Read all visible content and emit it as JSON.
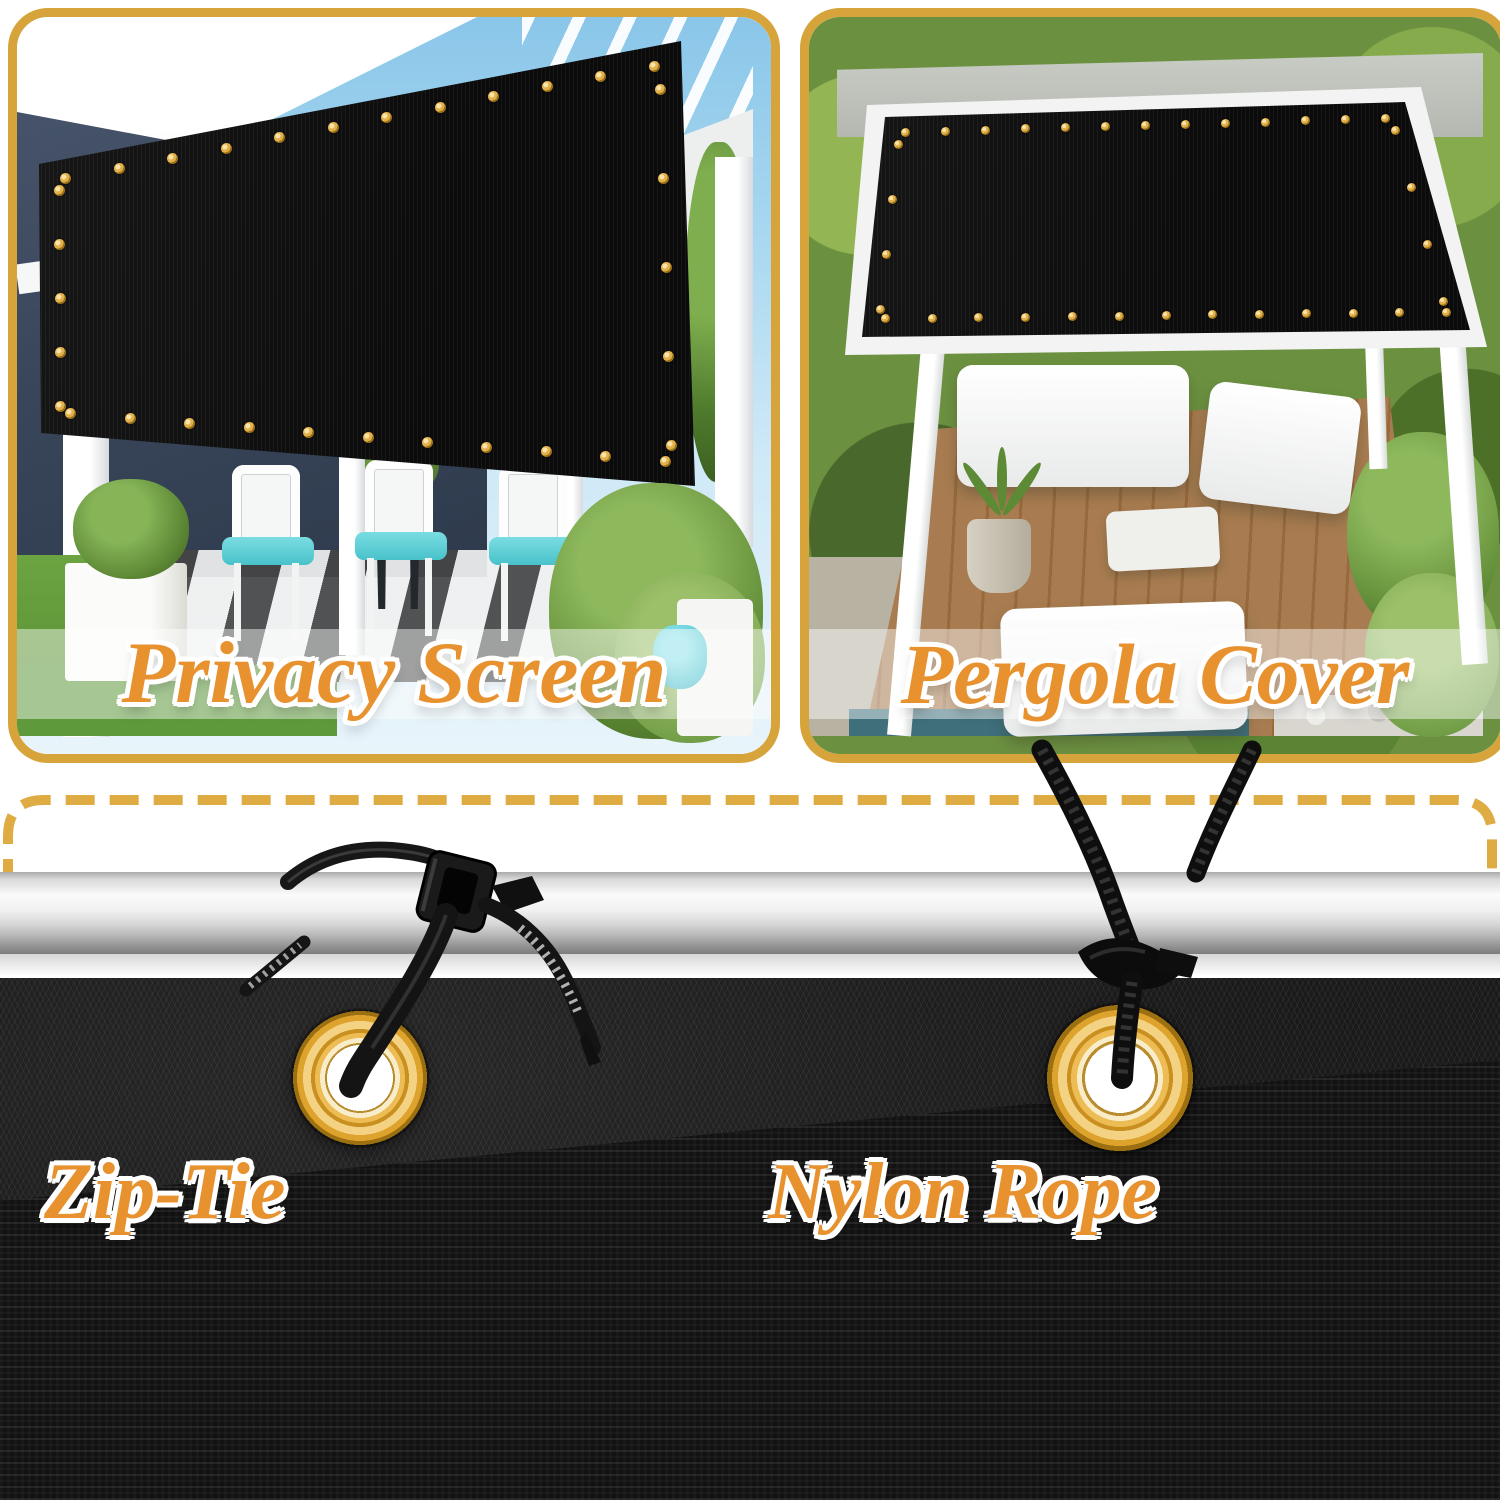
{
  "panels": {
    "privacy": {
      "caption": "Privacy Screen"
    },
    "pergola": {
      "caption": "Pergola Cover"
    }
  },
  "hardware": {
    "zip_tie_label": "Zip-Tie",
    "nylon_rope_label": "Nylon Rope"
  },
  "colors": {
    "accent_gold": "#D7A43C",
    "dashed_line": "#DFAB43",
    "label_orange": "#E8922F",
    "grommet_brass": "#DCA22F",
    "fabric_black": "#121212"
  }
}
